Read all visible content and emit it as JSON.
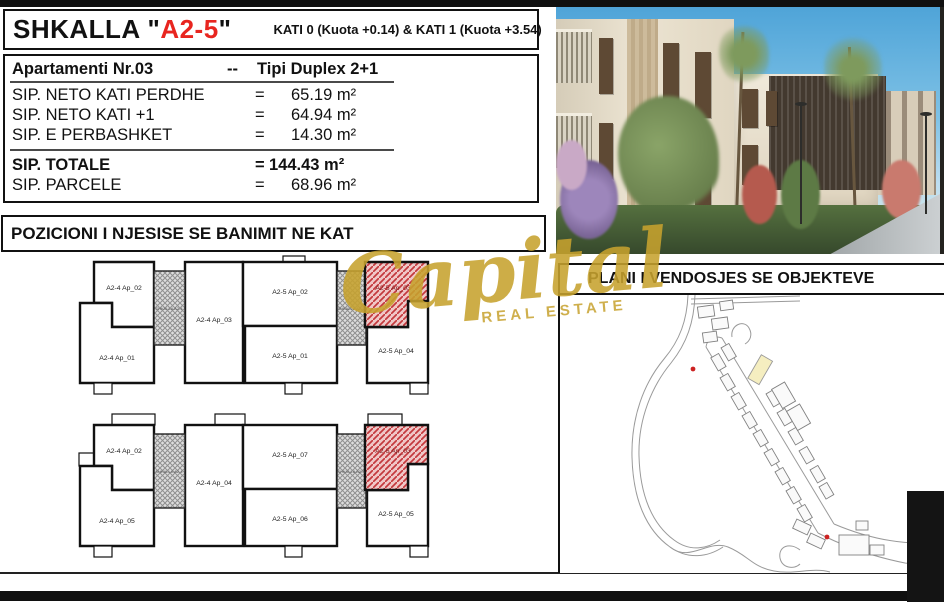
{
  "title_block": {
    "name": "SHKALLA",
    "quote_open": "\"",
    "code": "A2-5",
    "quote_close": "\"",
    "levels": "KATI 0 (Kuota +0.14) & KATI 1 (Kuota +3.54)"
  },
  "apartment_table": {
    "header": {
      "name": "Apartamenti Nr.03",
      "dash": "--",
      "type": "Tipi Duplex 2+1"
    },
    "rows": [
      {
        "label": "SIP. NETO KATI PERDHE",
        "eq": "=",
        "value": "65.19 m²"
      },
      {
        "label": "SIP. NETO KATI +1",
        "eq": "=",
        "value": "64.94 m²"
      },
      {
        "label": "SIP. E PERBASHKET",
        "eq": "=",
        "value": "14.30 m²"
      },
      {
        "label": "SIP. TOTALE",
        "eq": "=",
        "value": "144.43 m²"
      },
      {
        "label": "SIP. PARCELE",
        "eq": "=",
        "value": "68.96 m²"
      }
    ]
  },
  "sections": {
    "position_title": "POZICIONI I NJESISE SE BANIMIT NE KAT",
    "site_plan_title": "PLANI I VENDOSJES SE OBJEKTEVE"
  },
  "floor_plans": {
    "highlighted_unit": "A2-5 Ap_03",
    "upper": {
      "units": {
        "a24_ap02": "A2-4 Ap_02",
        "a24_ap01": "A2-4 Ap_01",
        "a24_ap03": "A2-4 Ap_03",
        "a25_ap02": "A2-5 Ap_02",
        "a25_ap01": "A2-5 Ap_01",
        "a25_ap03": "A2-5 Ap_03",
        "a25_ap04": "A2-5 Ap_04"
      },
      "stair_left": "SHKALLA A2-4",
      "stair_right": "SHKALLA A2-5"
    },
    "lower": {
      "units": {
        "a24_ap02": "A2-4 Ap_02",
        "a24_ap05": "A2-4 Ap_05",
        "a24_ap04": "A2-4 Ap_04",
        "a25_ap07": "A2-5 Ap_07",
        "a25_ap06": "A2-5 Ap_06",
        "a25_ap03": "A2-5 Ap_03",
        "a25_ap05": "A2-5 Ap_05"
      },
      "stair_left": "SHKALLA A2-4",
      "stair_right": "SHKALLA A2-5"
    }
  },
  "watermark": {
    "brand": "Capital",
    "tagline": "REAL ESTATE"
  },
  "colors": {
    "accent_red": "#e8251f",
    "highlight_fill": "#f0c7c7",
    "highlight_hatch": "#c4393d",
    "gold": "#c7a22e",
    "map_highlight": "#f5eec0",
    "bar_black": "#101010"
  }
}
